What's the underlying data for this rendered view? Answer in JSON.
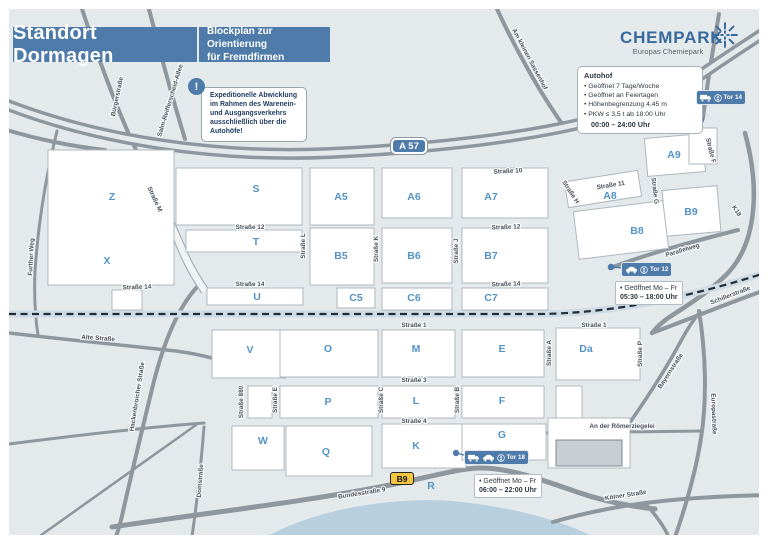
{
  "header": {
    "title": "Standort Dormagen",
    "subtitle_line1": "Blockplan zur Orientierung",
    "subtitle_line2": "für Fremdfirmen"
  },
  "brand": {
    "name": "CHEMPARK",
    "tagline": "Europas Chemiepark",
    "icon": "sunburst-icon"
  },
  "notice": {
    "icon": "exclamation-icon",
    "symbol": "!",
    "text": "Expeditionelle Abwicklung im Rahmen des Warenein- und Ausgangsverkehrs ausschließlich über die Autohöfe!"
  },
  "autohof": {
    "title": "Autohof",
    "items": [
      "• Geöffnet 7 Tage/Woche",
      "• Geöffnet an Feiertagen",
      "• Höhenbegrenzung 4,45 m",
      "• PKW ≤ 3,5 t ab 18:00 Uhr"
    ],
    "hours": "00:00 – 24:00 Uhr"
  },
  "road_badges": {
    "autobahn": "A 57",
    "bundesstrasse": "B9"
  },
  "map": {
    "gates": [
      {
        "id": "tor14",
        "label": "Tor 14",
        "icons": [
          "truck-icon",
          "pedestrian-icon"
        ],
        "badge": {
          "x": 696,
          "y": 90
        },
        "dot": {
          "x": 701,
          "y": 120
        }
      },
      {
        "id": "tor12",
        "label": "Tor 12",
        "icons": [
          "car-icon",
          "pedestrian-icon"
        ],
        "badge": {
          "x": 621,
          "y": 262
        },
        "dot": {
          "x": 611,
          "y": 267
        },
        "note": {
          "x": 615,
          "y": 281,
          "lines": [
            "• Geöffnet Mo – Fr",
            "05:30 – 18:00 Uhr"
          ]
        }
      },
      {
        "id": "tor18",
        "label": "Tor 18",
        "icons": [
          "truck-icon",
          "car-icon",
          "pedestrian-icon"
        ],
        "badge": {
          "x": 464,
          "y": 450
        },
        "dot": {
          "x": 456,
          "y": 453
        },
        "note": {
          "x": 474,
          "y": 474,
          "lines": [
            "• Geöffnet Mo – Fr",
            "06:00 – 22:00 Uhr"
          ]
        }
      }
    ],
    "blocks": [
      {
        "label": "Z",
        "x": 48,
        "y": 150,
        "w": 126,
        "h": 135,
        "lx": 112,
        "ly": 200
      },
      {
        "label": "X",
        "lx": 107,
        "ly": 264
      },
      {
        "label": "S",
        "x": 176,
        "y": 168,
        "w": 126,
        "h": 57,
        "lx": 256,
        "ly": 192
      },
      {
        "label": "A5",
        "x": 310,
        "y": 168,
        "w": 64,
        "h": 57,
        "lx": 341,
        "ly": 200
      },
      {
        "label": "A6",
        "x": 382,
        "y": 168,
        "w": 70,
        "h": 50,
        "lx": 414,
        "ly": 200
      },
      {
        "label": "A7",
        "x": 462,
        "y": 168,
        "w": 86,
        "h": 50,
        "lx": 491,
        "ly": 200
      },
      {
        "label": "A8",
        "x": 566,
        "y": 176,
        "w": 74,
        "h": 26,
        "r": -9,
        "lx": 610,
        "ly": 199
      },
      {
        "label": "A9",
        "x": 646,
        "y": 136,
        "w": 58,
        "h": 38,
        "r": -5,
        "lx": 674,
        "ly": 158
      },
      {
        "label": "B9",
        "x": 664,
        "y": 188,
        "w": 55,
        "h": 46,
        "r": -5,
        "lx": 691,
        "ly": 215
      },
      {
        "label": "B8",
        "x": 576,
        "y": 206,
        "w": 90,
        "h": 48,
        "r": -7,
        "lx": 637,
        "ly": 234
      },
      {
        "label": "T",
        "x": 186,
        "y": 230,
        "w": 116,
        "h": 22,
        "lx": 256,
        "ly": 245
      },
      {
        "label": "B5",
        "x": 310,
        "y": 228,
        "w": 64,
        "h": 57,
        "lx": 341,
        "ly": 259
      },
      {
        "label": "B6",
        "x": 382,
        "y": 228,
        "w": 70,
        "h": 55,
        "lx": 414,
        "ly": 259
      },
      {
        "label": "B7",
        "x": 462,
        "y": 228,
        "w": 86,
        "h": 55,
        "lx": 491,
        "ly": 259
      },
      {
        "label": "U",
        "x": 207,
        "y": 288,
        "w": 96,
        "h": 17,
        "lx": 257,
        "ly": 300
      },
      {
        "label": "C5",
        "x": 337,
        "y": 288,
        "w": 38,
        "h": 20,
        "lx": 356,
        "ly": 301
      },
      {
        "label": "C6",
        "x": 382,
        "y": 288,
        "w": 70,
        "h": 22,
        "lx": 414,
        "ly": 301
      },
      {
        "label": "C7",
        "x": 462,
        "y": 288,
        "w": 86,
        "h": 22,
        "lx": 491,
        "ly": 301
      },
      {
        "label": "V",
        "x": 212,
        "y": 330,
        "w": 74,
        "h": 48,
        "lx": 250,
        "ly": 353
      },
      {
        "label": "O",
        "x": 280,
        "y": 330,
        "w": 98,
        "h": 47,
        "lx": 328,
        "ly": 352
      },
      {
        "label": "M",
        "x": 382,
        "y": 330,
        "w": 73,
        "h": 47,
        "lx": 416,
        "ly": 352
      },
      {
        "label": "E",
        "x": 462,
        "y": 330,
        "w": 82,
        "h": 47,
        "lx": 502,
        "ly": 352
      },
      {
        "label": "Da",
        "x": 556,
        "y": 328,
        "w": 84,
        "h": 52,
        "lx": 586,
        "ly": 352
      },
      {
        "label": "P",
        "x": 280,
        "y": 386,
        "w": 98,
        "h": 32,
        "lx": 328,
        "ly": 405
      },
      {
        "label": "L",
        "x": 382,
        "y": 386,
        "w": 73,
        "h": 32,
        "lx": 416,
        "ly": 404
      },
      {
        "label": "F",
        "x": 462,
        "y": 386,
        "w": 82,
        "h": 32,
        "lx": 502,
        "ly": 404
      },
      {
        "label": "W",
        "x": 232,
        "y": 426,
        "w": 52,
        "h": 44,
        "lx": 263,
        "ly": 444
      },
      {
        "label": "Q",
        "x": 286,
        "y": 426,
        "w": 86,
        "h": 50,
        "lx": 326,
        "ly": 455
      },
      {
        "label": "K",
        "x": 382,
        "y": 424,
        "w": 84,
        "h": 44,
        "lx": 416,
        "ly": 449
      },
      {
        "label": "G",
        "x": 462,
        "y": 424,
        "w": 84,
        "h": 36,
        "lx": 502,
        "ly": 438
      },
      {
        "label": "R",
        "lx": 431,
        "ly": 489
      },
      {
        "x": 248,
        "y": 386,
        "w": 24,
        "h": 32
      },
      {
        "x": 556,
        "y": 386,
        "w": 26,
        "h": 32
      },
      {
        "x": 112,
        "y": 290,
        "w": 30,
        "h": 20
      },
      {
        "x": 548,
        "y": 418,
        "w": 82,
        "h": 50
      },
      {
        "x": 689,
        "y": 128,
        "w": 28,
        "h": 36
      }
    ],
    "streets": [
      {
        "n": "Bürgerstraße",
        "x": 119,
        "y": 97,
        "a": -78
      },
      {
        "n": "Salm-Reifferscheid-Allee",
        "x": 172,
        "y": 101,
        "a": -73
      },
      {
        "n": "Am kleinen Sassenhof",
        "x": 528,
        "y": 60,
        "a": 62
      },
      {
        "n": "Further Weg",
        "x": 33,
        "y": 257,
        "a": -87
      },
      {
        "n": "Straße M",
        "x": 153,
        "y": 200,
        "a": 65
      },
      {
        "n": "Straße 10",
        "x": 508,
        "y": 173,
        "a": -3
      },
      {
        "n": "Straße 11",
        "x": 611,
        "y": 187,
        "a": -9
      },
      {
        "n": "Straße 12",
        "x": 250,
        "y": 229,
        "a": 0
      },
      {
        "n": "Straße 12",
        "x": 506,
        "y": 229,
        "a": -2
      },
      {
        "n": "Straße 14",
        "x": 137,
        "y": 289,
        "a": -2
      },
      {
        "n": "Straße 14",
        "x": 250,
        "y": 286,
        "a": 0
      },
      {
        "n": "Straße 14",
        "x": 506,
        "y": 286,
        "a": -2
      },
      {
        "n": "Straße L",
        "x": 305,
        "y": 246,
        "a": -90
      },
      {
        "n": "Straße K",
        "x": 378,
        "y": 249,
        "a": -90
      },
      {
        "n": "Straße J",
        "x": 458,
        "y": 251,
        "a": -90
      },
      {
        "n": "Straße H",
        "x": 569,
        "y": 193,
        "a": 57
      },
      {
        "n": "Straße G",
        "x": 653,
        "y": 191,
        "a": 83
      },
      {
        "n": "Straße F",
        "x": 709,
        "y": 151,
        "a": 76
      },
      {
        "n": "K18",
        "x": 735,
        "y": 212,
        "a": 57
      },
      {
        "n": "Parallelweg",
        "x": 683,
        "y": 252,
        "a": -17
      },
      {
        "n": "Schillerstraße",
        "x": 731,
        "y": 297,
        "a": -21
      },
      {
        "n": "Straße 1",
        "x": 414,
        "y": 327,
        "a": 0
      },
      {
        "n": "Straße 1",
        "x": 594,
        "y": 327,
        "a": 0
      },
      {
        "n": "Straße 3",
        "x": 414,
        "y": 382,
        "a": 0
      },
      {
        "n": "Straße 4",
        "x": 414,
        "y": 423,
        "a": 0
      },
      {
        "n": "Straße 880",
        "x": 243,
        "y": 402,
        "a": -90
      },
      {
        "n": "Straße E",
        "x": 277,
        "y": 400,
        "a": -90
      },
      {
        "n": "Straße C",
        "x": 383,
        "y": 400,
        "a": -90
      },
      {
        "n": "Straße B",
        "x": 459,
        "y": 400,
        "a": -90
      },
      {
        "n": "Straße A",
        "x": 551,
        "y": 353,
        "a": -90
      },
      {
        "n": "Straße P",
        "x": 642,
        "y": 354,
        "a": -90
      },
      {
        "n": "Alte Straße",
        "x": 98,
        "y": 340,
        "a": 4
      },
      {
        "n": "Hackenbroicher Straße",
        "x": 139,
        "y": 397,
        "a": -81
      },
      {
        "n": "Bayernstraße",
        "x": 672,
        "y": 372,
        "a": -57
      },
      {
        "n": "Europastraße",
        "x": 712,
        "y": 414,
        "a": 88
      },
      {
        "n": "An der Römerziegelei",
        "x": 622,
        "y": 428,
        "a": 0
      },
      {
        "n": "Kölner Straße",
        "x": 626,
        "y": 497,
        "a": -9
      },
      {
        "n": "Bundesstraße 9",
        "x": 362,
        "y": 495,
        "a": -9
      },
      {
        "n": "Domstraße",
        "x": 202,
        "y": 481,
        "a": -86
      }
    ]
  },
  "colors": {
    "accent_blue": "#4e7ba9",
    "block_label_blue": "#5593c5",
    "map_background": "#e4e9ec",
    "road_gray": "#8e979e",
    "river_blue": "#b7cfdf",
    "b9_yellow": "#f3c63e",
    "rail_dash": "#222c36"
  }
}
